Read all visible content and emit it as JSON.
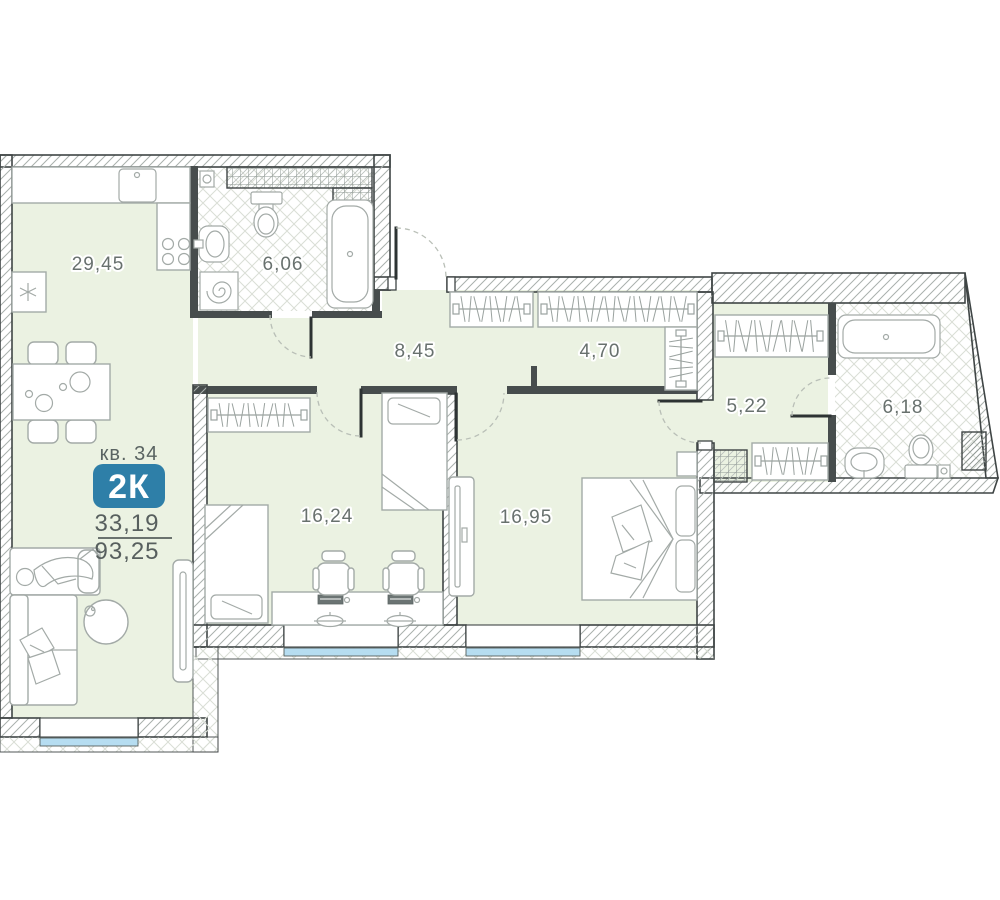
{
  "info": {
    "apartment_label": "кв. 34",
    "type_badge": "2К",
    "area_upper": "33,19",
    "area_lower": "93,25"
  },
  "rooms": [
    {
      "name": "kitchen-living-room",
      "area": "29,45"
    },
    {
      "name": "bathroom-1",
      "area": "6,06"
    },
    {
      "name": "hallway",
      "area": "8,45"
    },
    {
      "name": "corridor-wardrobe",
      "area": "4,70"
    },
    {
      "name": "corridor-2",
      "area": "5,22"
    },
    {
      "name": "bathroom-2",
      "area": "6,18"
    },
    {
      "name": "bedroom-1",
      "area": "16,24"
    },
    {
      "name": "bedroom-2",
      "area": "16,95"
    }
  ],
  "colors": {
    "badge": "#2e7fa8",
    "room_fill": "#ebf2e2",
    "glass": "#b6ddf1"
  }
}
